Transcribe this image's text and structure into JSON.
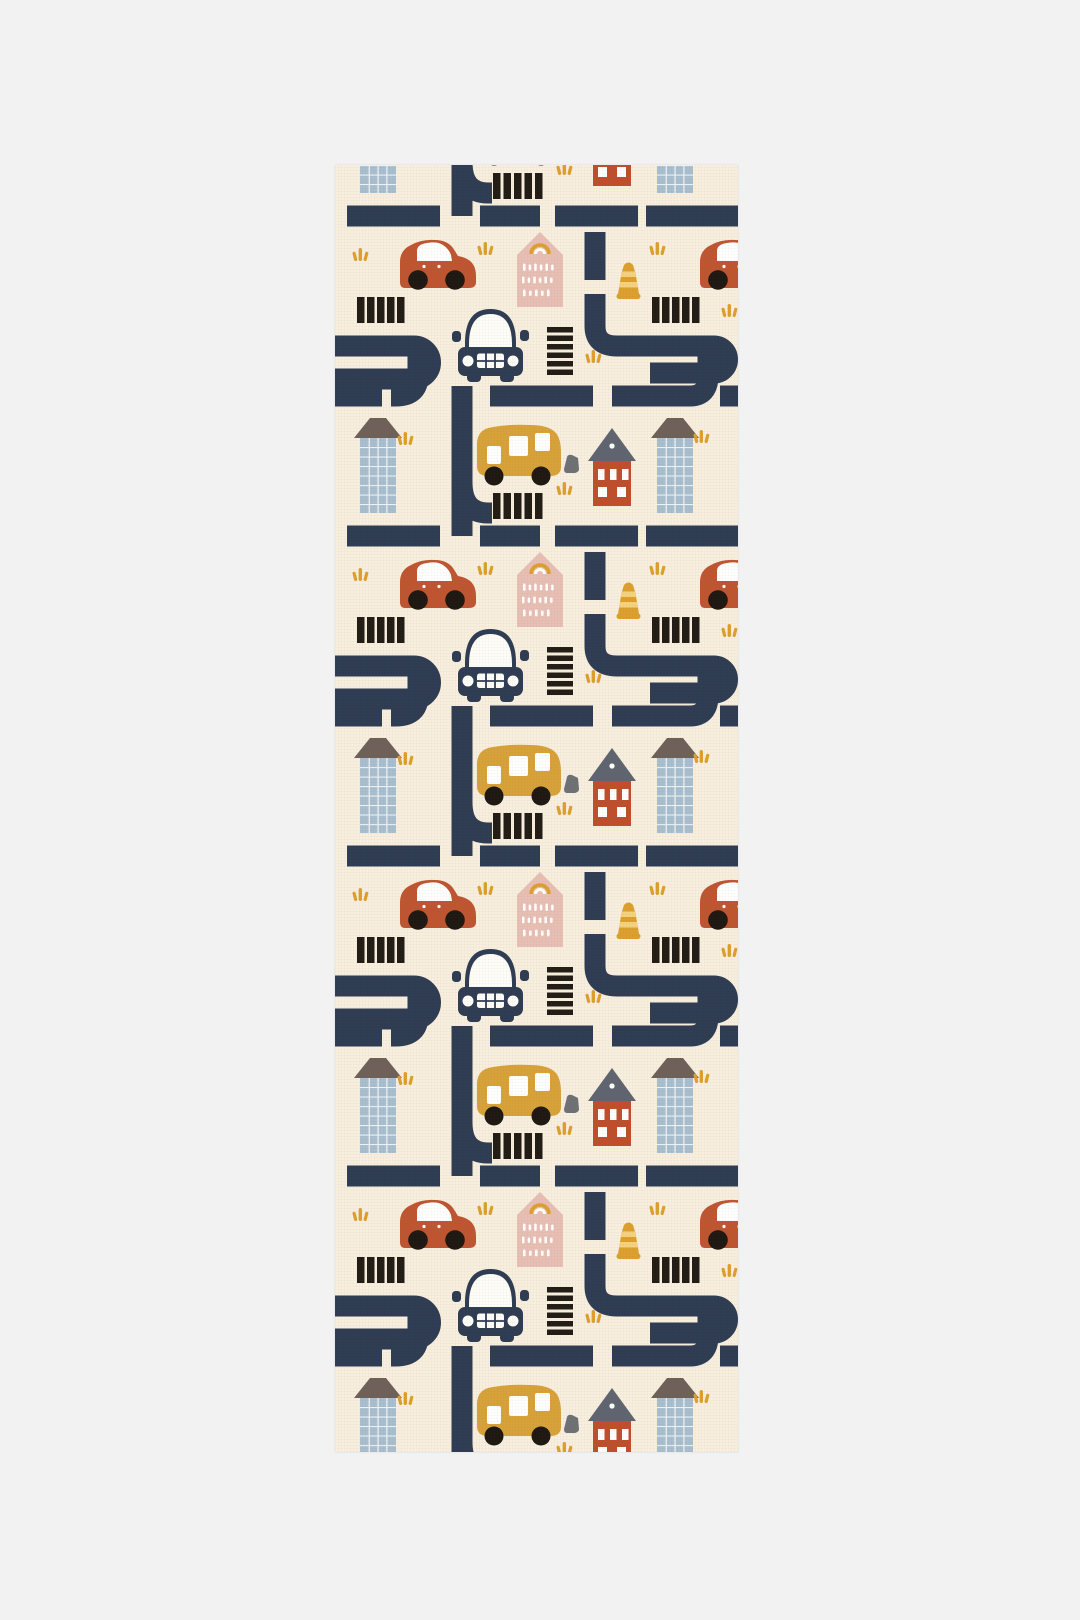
{
  "image": {
    "kind": "product-photo",
    "subject": "Children's toy-town road play mat / rug runner with a repeating traffic pattern",
    "orientation": "tall vertical runner centered on a plain light-gray backdrop"
  },
  "backdrop": {
    "color": "#f2f2f3"
  },
  "mat": {
    "background": "#f8efdf"
  },
  "palette": {
    "road_navy": "#2e3c53",
    "car_rust": "#bf5531",
    "bus_mustard": "#d8a23a",
    "house_pink": "#e8bfb4",
    "house_red": "#bf4f2c",
    "red_house_roof": "#5f6570",
    "building_blue": "#a9bfd0",
    "building_roof_taupe": "#6e6159",
    "crosswalk_black": "#211c15",
    "accent_mustard": "#dda02f",
    "cone_band": "#f5d37e",
    "rock_gray": "#6e7275",
    "white": "#fffdf8"
  },
  "pattern_repeat": {
    "direction": "vertical",
    "period_px": 320,
    "visible_repeats": 4
  },
  "motifs": [
    {
      "name": "navy-road-network",
      "description": "dashed streets, elbows and 180-degree bends"
    },
    {
      "name": "red-car-side-view",
      "visible_full": 4,
      "visible_clipped_right_edge": 4
    },
    {
      "name": "white-car-front-view",
      "visible_full": 4
    },
    {
      "name": "yellow-bus",
      "visible_full": 4
    },
    {
      "name": "pink-house-with-rainbow",
      "visible_full": 4
    },
    {
      "name": "red-house-gray-roof",
      "visible_full": 4,
      "visible_partial": 1
    },
    {
      "name": "tall-blue-building",
      "visible_full": 8,
      "visible_partial": 2
    },
    {
      "name": "traffic-cone",
      "visible_full": 4
    },
    {
      "name": "crosswalk-stripes",
      "visible_groups": 17
    },
    {
      "name": "gray-rock",
      "visible_full": 4
    },
    {
      "name": "grass-tuft",
      "visible_approx": 33
    }
  ]
}
